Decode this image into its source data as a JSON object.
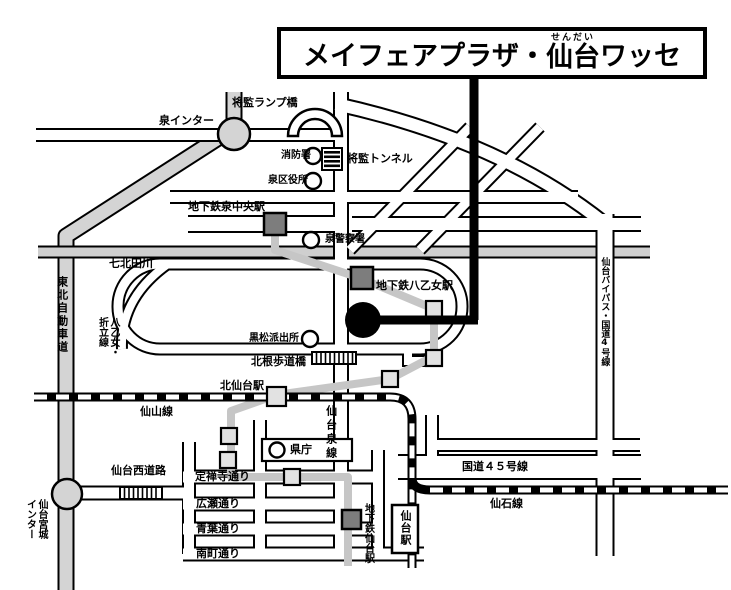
{
  "title": {
    "part1": "メイフェアプラザ・",
    "ruby_base": "仙台",
    "ruby_text": "せんだい",
    "part2": "ワッセ"
  },
  "labels": {
    "shokan_ramp_bridge": "将監ランプ橋",
    "izumi_interchange": "泉インター",
    "fire_station": "消防署",
    "shokan_tunnel": "将監トンネル",
    "izumi_ward_office": "泉区役所",
    "subway_izumi_chuo_station": "地下鉄泉中央駅",
    "izumi_police_station": "泉警察署",
    "nanakita_river": "七北田川",
    "tohoku_expressway": "東北自動車道",
    "yaotome_oritate_line": "八乙女・\n折立線",
    "subway_yaotome_station": "地下鉄八乙女駅",
    "kuromatsu_police_box": "黒松派出所",
    "kitane_footbridge": "北根歩道橋",
    "kita_sendai_station": "北仙台駅",
    "senzan_line": "仙山線",
    "sendai_izumi_line": "仙台泉線",
    "prefectural_office": "県庁",
    "jozenji_street": "定禅寺通り",
    "sendai_west_road": "仙台西道路",
    "hirose_street": "広瀬通り",
    "aoba_street": "青葉通り",
    "minamimachi_street": "南町通り",
    "route_45": "国道４５号線",
    "senseki_line": "仙石線",
    "subway_sendai_station": "地下鉄仙台駅",
    "sendai_station": "仙台駅",
    "sendai_miyagi_interchange": "仙台宮城\nインター",
    "sendai_bypass_route4": "仙台バイパス・国道4号線"
  },
  "colors": {
    "highway_gray": "#d4d4d4",
    "river_gray": "#cfcfcf",
    "subway_gray": "#c6c6c6",
    "station_dark": "#7d7d7d",
    "station_light": "#e2e2e2",
    "line_black": "#000000"
  }
}
